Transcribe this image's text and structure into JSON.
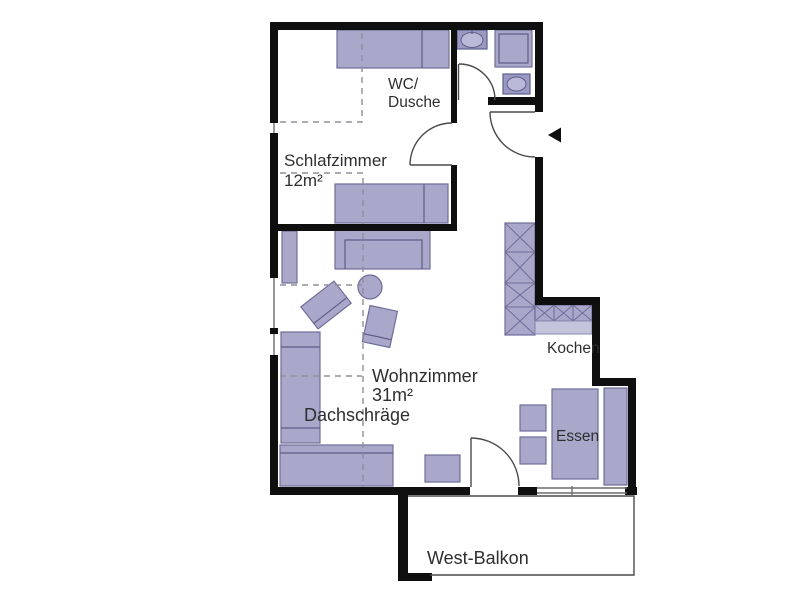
{
  "floorplan": {
    "rooms": {
      "schlafzimmer": {
        "label": "Schlafzimmer",
        "area": "12m²"
      },
      "wohnzimmer": {
        "label": "Wohnzimmer",
        "area": "31m²"
      },
      "bad": {
        "label_line1": "WC/",
        "label_line2": "Dusche"
      },
      "kueche": {
        "label": "Kochen"
      },
      "essbereich": {
        "label": "Essen"
      },
      "balkon": {
        "label": "West-Balkon"
      }
    },
    "annotations": {
      "dachschraege": "Dachschräge"
    },
    "colors": {
      "wall": "#0f0f0f",
      "furniture_fill": "#a9a8ca",
      "furniture_border": "#6e6d99",
      "fixture_dark": "#9a99c2",
      "fixture_light": "#bab9d8",
      "counter_apron": "#c5c4dd",
      "dashed_line": "#8f8f9a",
      "text": "#2e2e2e",
      "background": "#ffffff"
    }
  }
}
